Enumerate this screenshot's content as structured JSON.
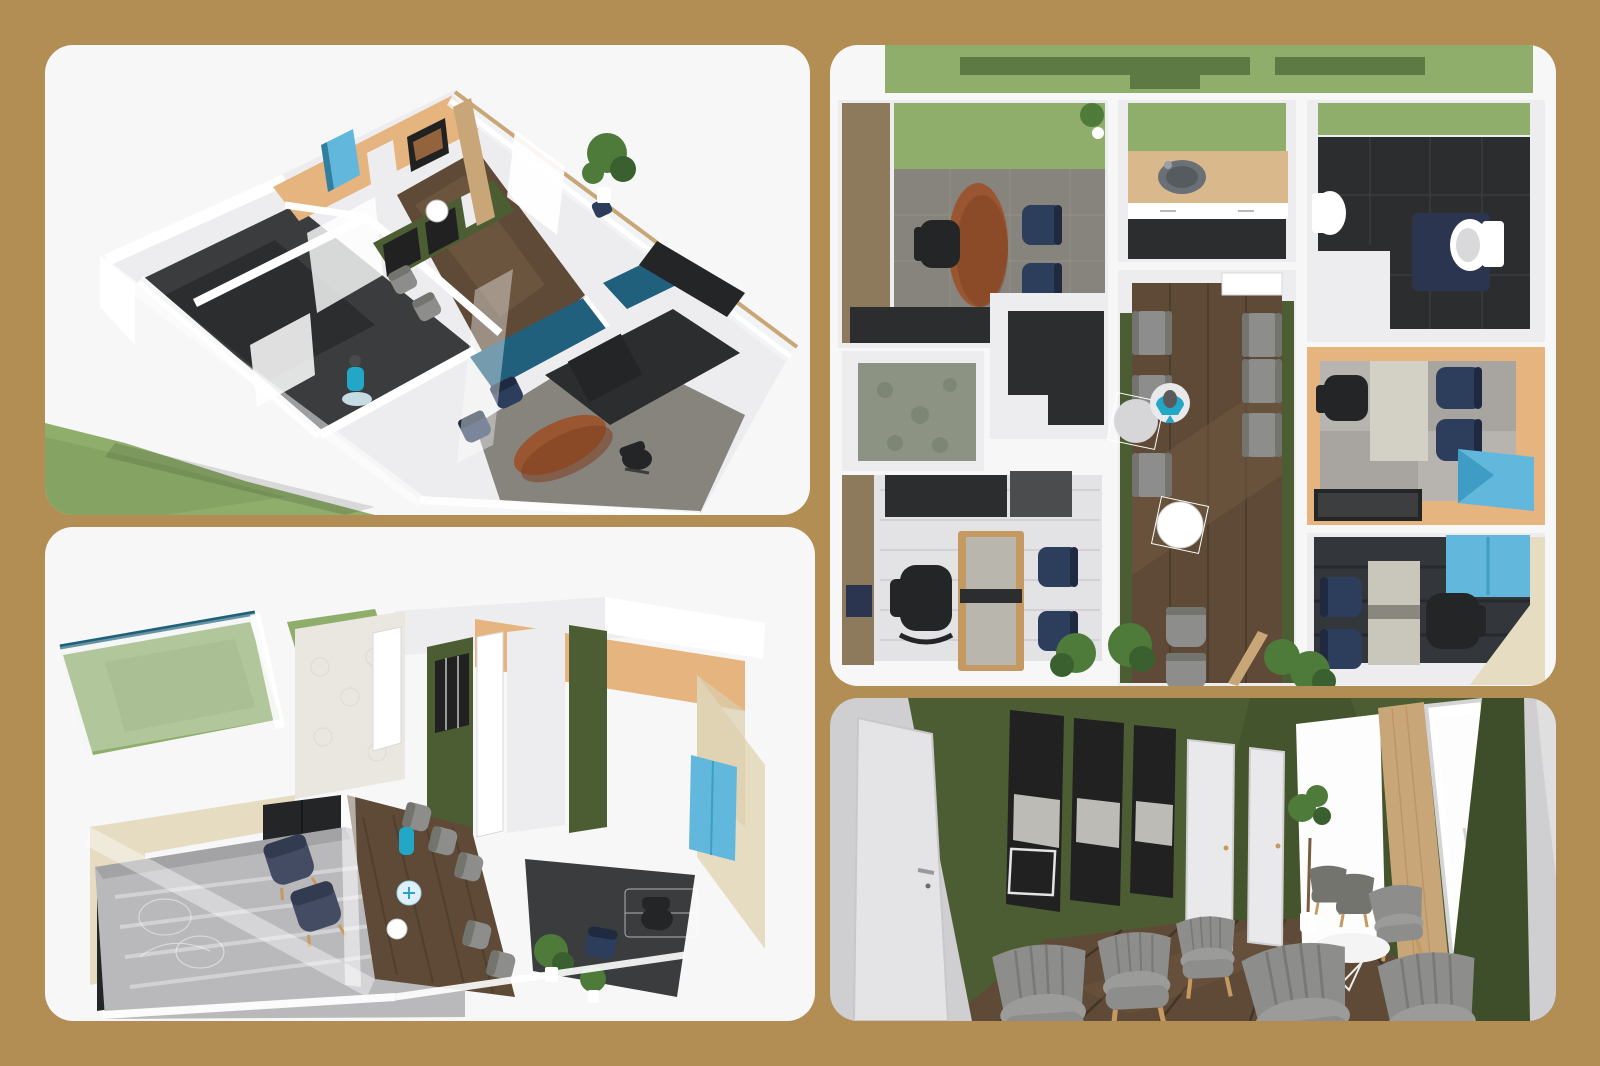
{
  "collage": {
    "panels": [
      {
        "id": "panel-iso-a",
        "name": "isometric-floor-plan-view-a"
      },
      {
        "id": "panel-iso-b",
        "name": "isometric-floor-plan-view-b"
      },
      {
        "id": "panel-plan",
        "name": "top-down-floor-plan"
      },
      {
        "id": "panel-room",
        "name": "waiting-room-interior-view"
      }
    ]
  },
  "palette": {
    "background": "#b28e55",
    "panel_bg": "#f7f7f8",
    "grass": "#8fae6b",
    "grass_shade": "#7d9c5c",
    "hedge": "#5e7a44",
    "wall_white": "#ffffff",
    "wall_soft": "#ededef",
    "wall_shade": "#d9d9dc",
    "wall_gray": "#cfcfd2",
    "brown_wall": "#8d7a5c",
    "floor_dark": "#3a3c3e",
    "floor_charcoal": "#2b2d2f",
    "floor_gray": "#87847e",
    "floor_light": "#d6d6d8",
    "carpet_gray": "#b9b9bc",
    "wood_floor": "#5e4a36",
    "wood_dark": "#46382a",
    "wood_light": "#755d44",
    "counter_wood": "#d9b98c",
    "partition_wood": "#c9a678",
    "tan_wall": "#e5b47f",
    "beige_wall": "#e6dcc2",
    "olive": "#4c5c33",
    "olive_dark": "#3f4e2a",
    "teal_wall": "#20607c",
    "navy": "#2d3d5c",
    "slate_chair": "#434c63",
    "gray_chair": "#8d8d8b",
    "gray_chair_dark": "#74746f",
    "brown_table": "#9a5531",
    "black_furniture": "#242527",
    "blue_cabinet": "#62b8dc",
    "person": "#23a7c6",
    "leg_wood": "#c49a62",
    "plant": "#4e7a3a",
    "plant_dark": "#3a6030",
    "art_dark": "#212121",
    "mat_navy": "#2b3550",
    "window_glass": "#f1f3f4",
    "bright_light": "#fdfdfd"
  }
}
